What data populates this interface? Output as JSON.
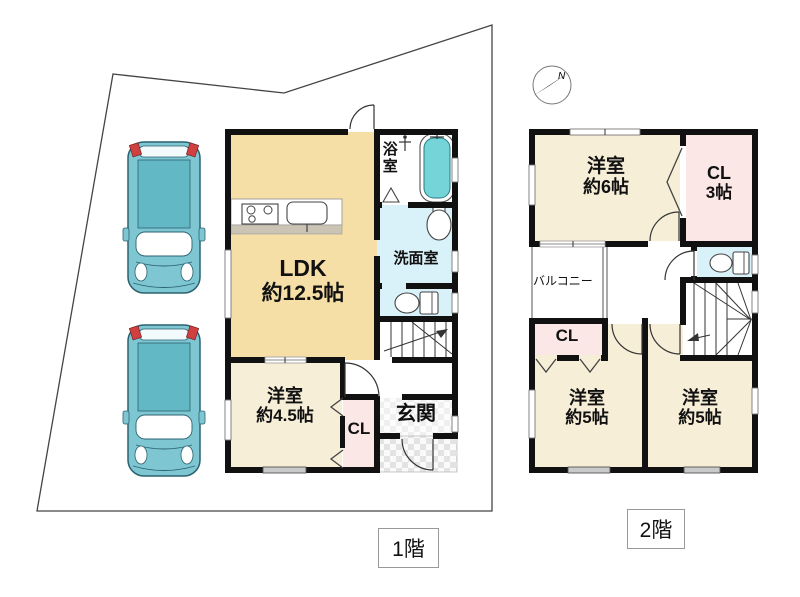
{
  "page": {
    "floor1_tag": "1階",
    "floor2_tag": "2階"
  },
  "compass": {
    "north_label": "N"
  },
  "floor1": {
    "ldk_name": "LDK",
    "ldk_size": "約12.5帖",
    "bath": "浴室",
    "washroom": "洗面室",
    "west_room_name": "洋室",
    "west_room_size": "約4.5帖",
    "closet": "CL",
    "entrance": "玄関"
  },
  "floor2": {
    "west6_name": "洋室",
    "west6_size": "約6帖",
    "cl3_name": "CL",
    "cl3_size": "3帖",
    "balcony": "バルコニー",
    "closet": "CL",
    "west5l_name": "洋室",
    "west5l_size": "約5帖",
    "west5r_name": "洋室",
    "west5r_size": "約5帖"
  },
  "colors": {
    "ldk_fill": "#f6dfa6",
    "room_fill": "#f7eed8",
    "closet_fill": "#fbe7e5",
    "wet_fill": "#d9f1f8",
    "bath_fill": "#ffffff",
    "tub_fill": "#74d4d8",
    "counter_gray": "#cbc3b3",
    "car_body": "#7ec7d2",
    "car_roof": "#63b8c6",
    "car_light": "#d14040",
    "wall": "#111111",
    "boundary": "#444444"
  }
}
